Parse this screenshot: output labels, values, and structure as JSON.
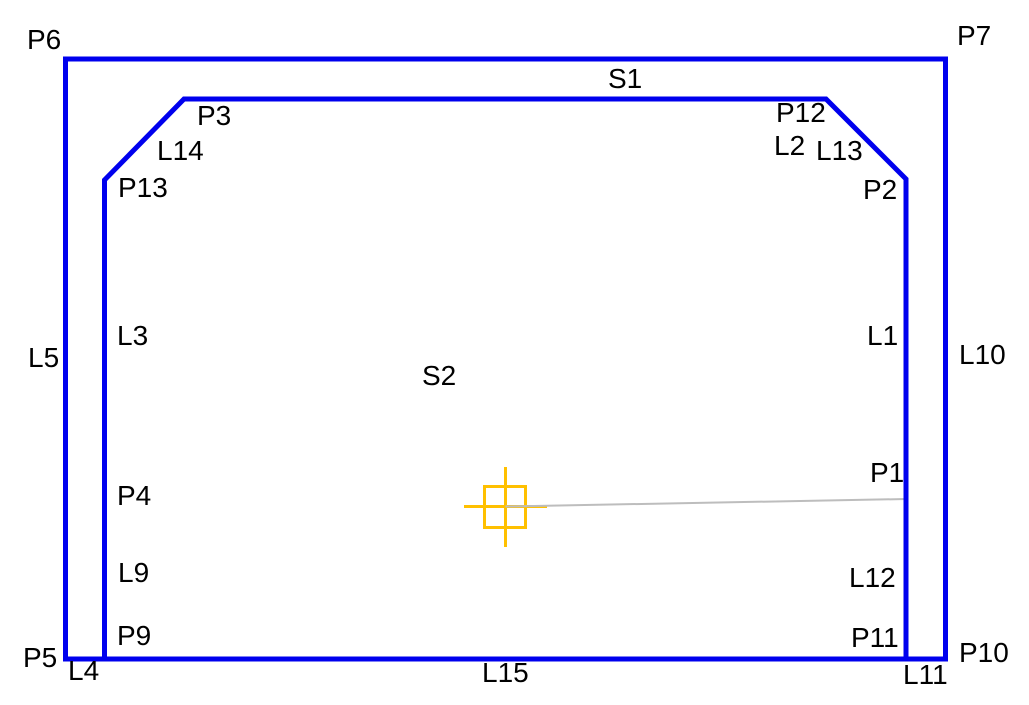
{
  "scene": {
    "background": "#ffffff",
    "colors": {
      "geometry": "#0000ee",
      "marker": "#ffc000",
      "reference_line": "#bdbdbd",
      "text": "#000000"
    }
  },
  "labels": {
    "p1": "P1",
    "p2": "P2",
    "p3": "P3",
    "p4": "P4",
    "p5": "P5",
    "p6": "P6",
    "p7": "P7",
    "p9": "P9",
    "p10": "P10",
    "p11": "P11",
    "p12": "P12",
    "p13": "P13",
    "l1": "L1",
    "l2": "L2",
    "l3": "L3",
    "l4": "L4",
    "l5": "L5",
    "l9": "L9",
    "l10": "L10",
    "l11": "L11",
    "l12": "L12",
    "l13": "L13",
    "l14": "L14",
    "l15": "L15",
    "s1": "S1",
    "s2": "S2"
  }
}
